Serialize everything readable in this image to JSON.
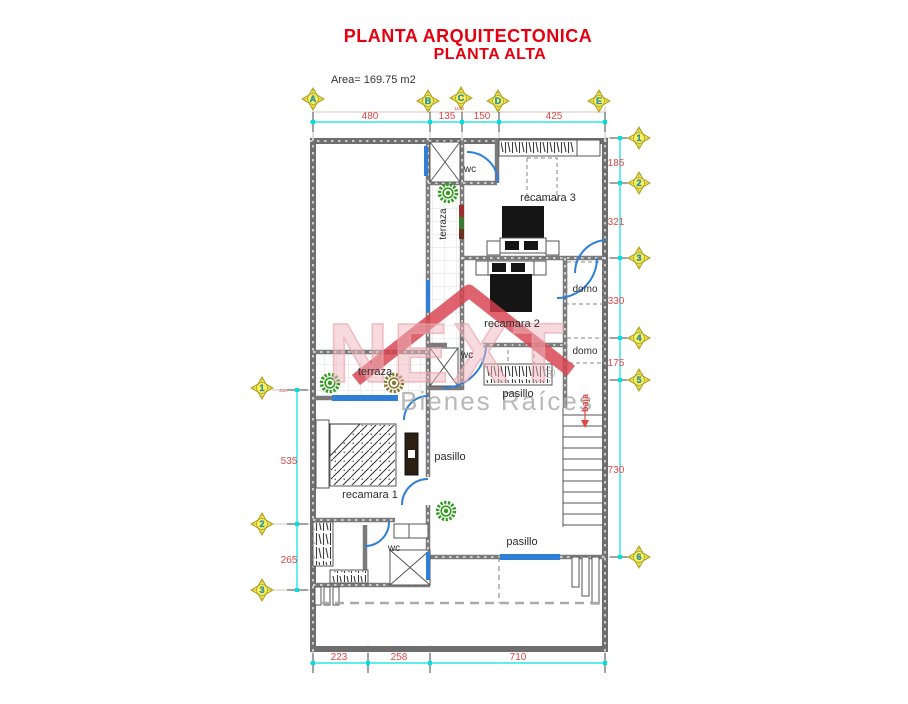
{
  "header": {
    "title_line1": "PLANTA ARQUITECTONICA",
    "title_line2": "PLANTA ALTA",
    "area_label": "Area= 169.75 m2"
  },
  "watermark": {
    "brand": "NEXT",
    "registered": "®",
    "subtitle": "Bienes Raíces"
  },
  "grid_markers": {
    "top": [
      "A",
      "B",
      "C",
      "D",
      "E"
    ],
    "right": [
      "1",
      "2",
      "3",
      "4",
      "5",
      "6"
    ],
    "left": [
      "1",
      "2",
      "3"
    ]
  },
  "dimensions": {
    "top": [
      "480",
      "135",
      "150",
      "425"
    ],
    "top_total": "1190",
    "right": [
      "185",
      "321",
      "330",
      "175",
      "730"
    ],
    "left": [
      "535",
      "265"
    ],
    "left_note": "216",
    "bottom": [
      "223",
      "258",
      "710"
    ]
  },
  "room_labels": {
    "wc_top": "wc",
    "recamara3": "recamara 3",
    "terraza_vertical": "terraza",
    "recamara2": "recamara 2",
    "domo_upper": "domo",
    "wc_mid": "wc",
    "domo_lower": "domo",
    "pasillo_mid": "pasillo",
    "baja": "baja",
    "terraza_left": "terraza",
    "recamara1": "recamara 1",
    "pasillo_center": "pasillo",
    "wc_bottom": "wc",
    "pasillo_bottom": "pasillo"
  },
  "colors": {
    "titlered": "#E6000F",
    "dimred": "#E04848",
    "dimcyan": "#00E0E0",
    "doorblue": "#2F7FD6",
    "markeryellow": "#F8F360",
    "markercyan": "#12B8DC",
    "plantgreen": "#2F9C1D",
    "plantolive": "#8A7A30",
    "wmred": "#D8414E",
    "wmpink": "#EEB6BC",
    "wmgray": "#A8A8A8"
  }
}
